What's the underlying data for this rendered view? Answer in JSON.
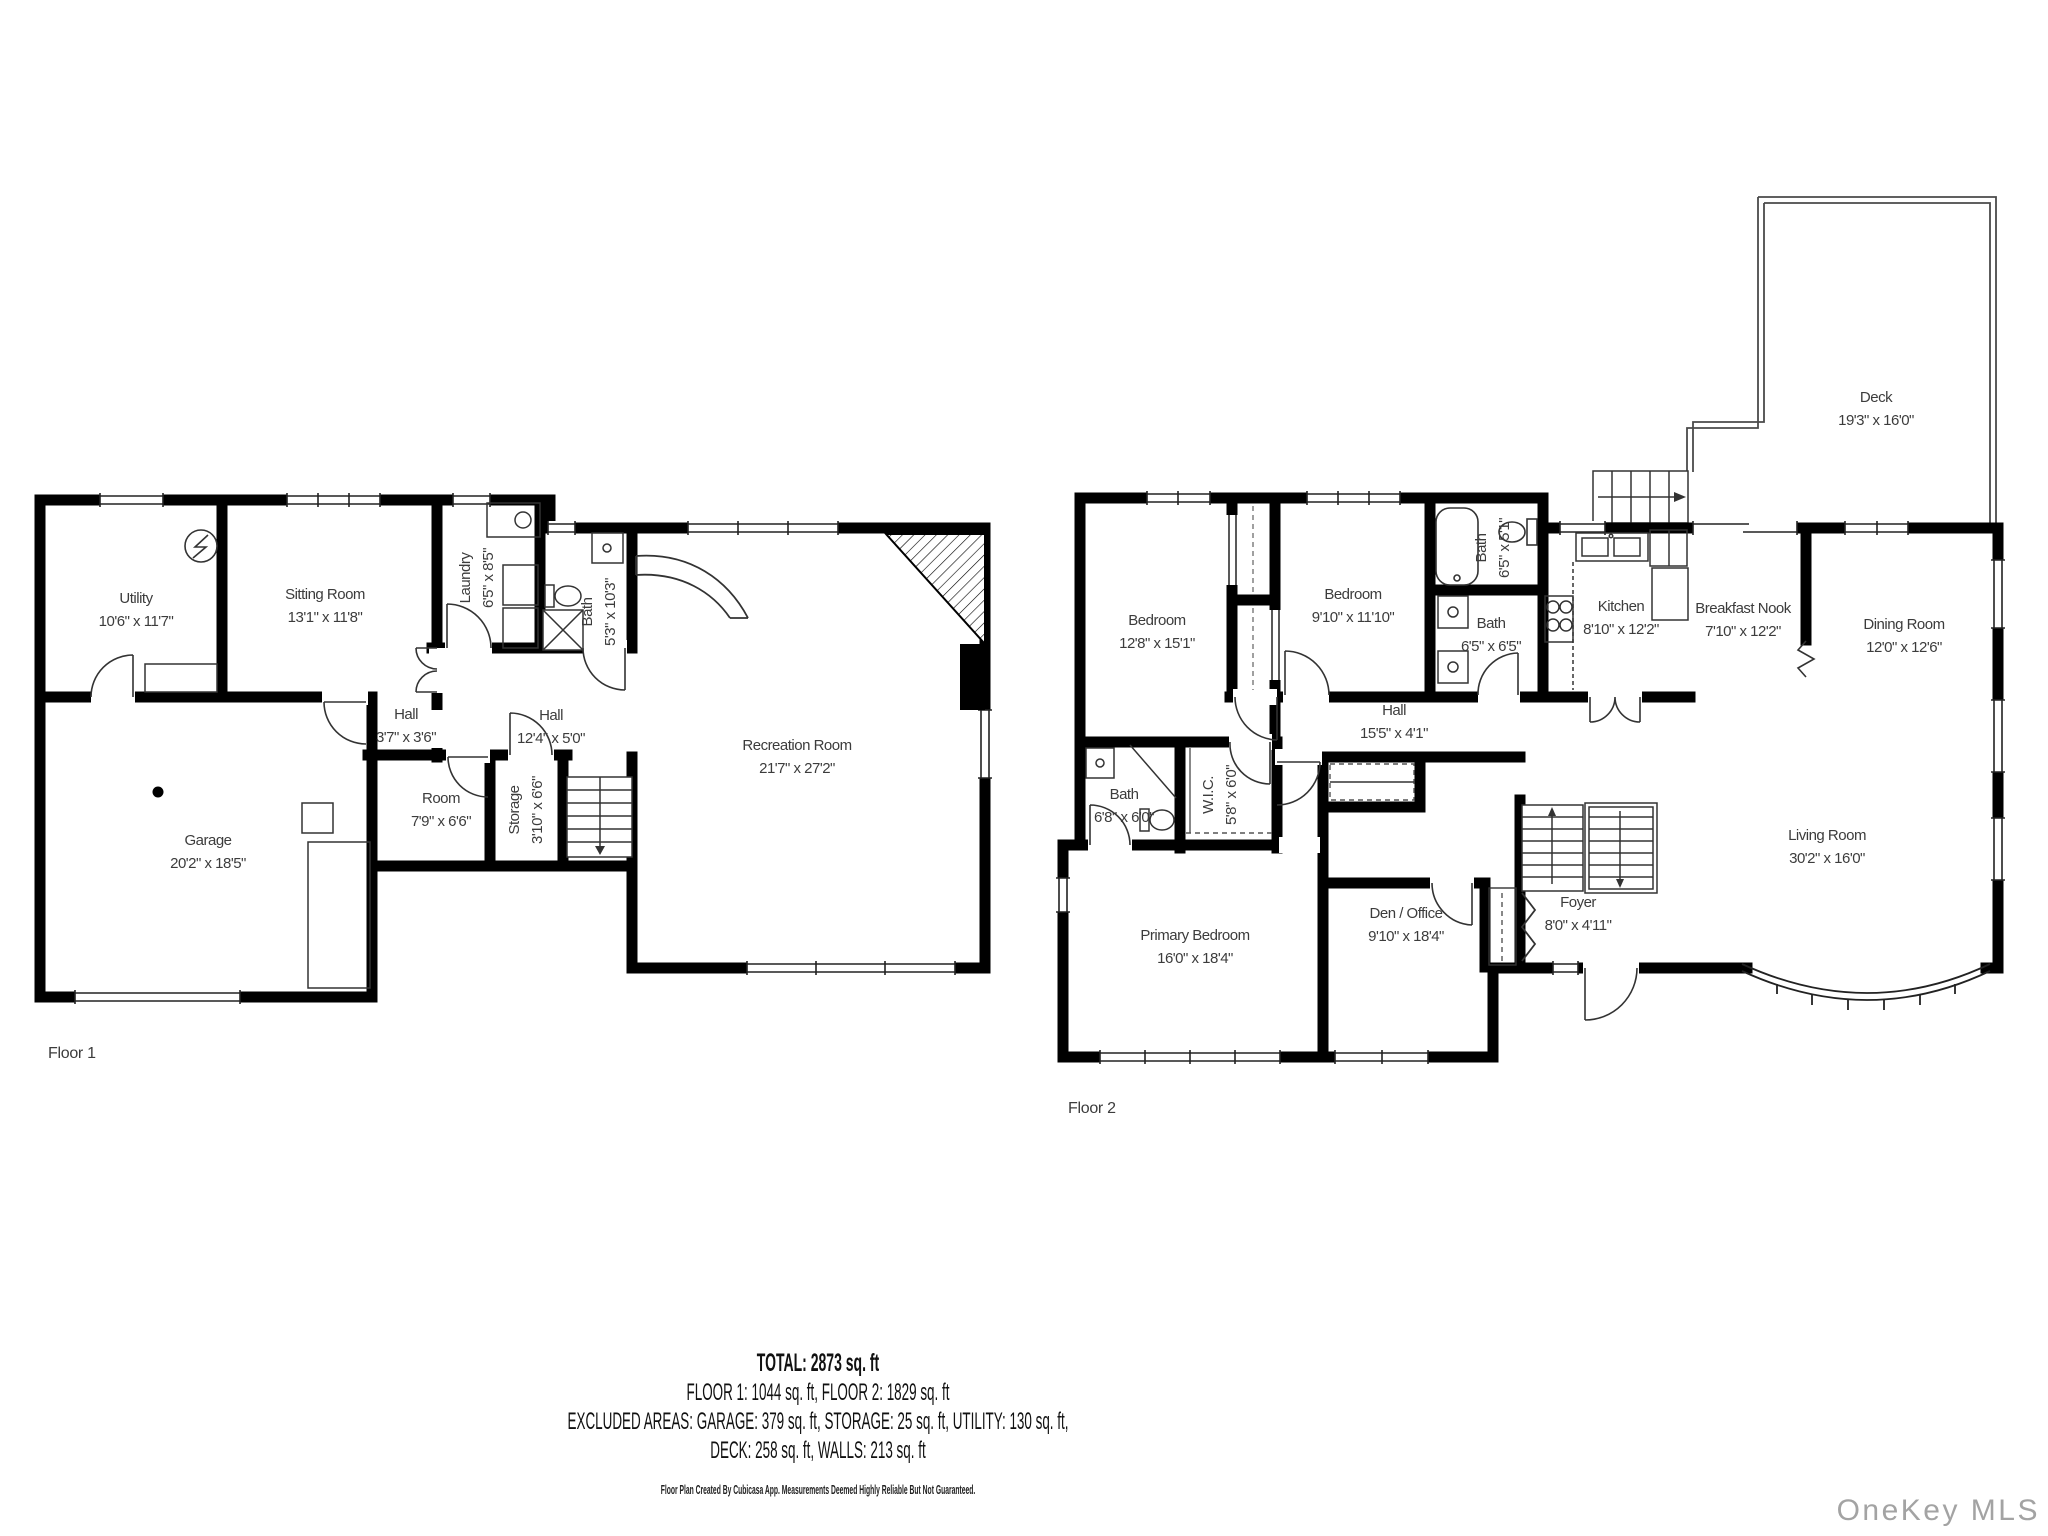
{
  "colors": {
    "wall": "#000000",
    "label_text": "#3c3c3c",
    "summary_text": "#111111",
    "watermark": "#a3a3a3",
    "thin_line": "#222222"
  },
  "floor1": {
    "label": "Floor 1",
    "rooms": {
      "utility": {
        "name": "Utility",
        "dims": "10'6\" x 11'7\""
      },
      "sitting_room": {
        "name": "Sitting Room",
        "dims": "13'1\" x 11'8\""
      },
      "laundry": {
        "name": "Laundry",
        "dims": "6'5\" x 8'5\""
      },
      "bath": {
        "name": "Bath",
        "dims": "5'3\" x 10'3\""
      },
      "hall_small": {
        "name": "Hall",
        "dims": "3'7\" x 3'6\""
      },
      "hall": {
        "name": "Hall",
        "dims": "12'4\" x 5'0\""
      },
      "room": {
        "name": "Room",
        "dims": "7'9\" x 6'6\""
      },
      "storage": {
        "name": "Storage",
        "dims": "3'10\" x 6'6\""
      },
      "garage": {
        "name": "Garage",
        "dims": "20'2\" x 18'5\""
      },
      "recreation_room": {
        "name": "Recreation Room",
        "dims": "21'7\" x 27'2\""
      }
    }
  },
  "floor2": {
    "label": "Floor 2",
    "rooms": {
      "bedroom1": {
        "name": "Bedroom",
        "dims": "12'8\" x 15'1\""
      },
      "bedroom2": {
        "name": "Bedroom",
        "dims": "9'10\" x 11'10\""
      },
      "bath_upper": {
        "name": "Bath",
        "dims": "6'5\" x 5'1\""
      },
      "bath_mid": {
        "name": "Bath",
        "dims": "6'5\" x 6'5\""
      },
      "kitchen": {
        "name": "Kitchen",
        "dims": "8'10\" x 12'2\""
      },
      "breakfast_nook": {
        "name": "Breakfast Nook",
        "dims": "7'10\" x 12'2\""
      },
      "dining_room": {
        "name": "Dining Room",
        "dims": "12'0\" x 12'6\""
      },
      "deck": {
        "name": "Deck",
        "dims": "19'3\" x 16'0\""
      },
      "hall": {
        "name": "Hall",
        "dims": "15'5\" x 4'1\""
      },
      "bath_lower": {
        "name": "Bath",
        "dims": "6'8\" x 6'0\""
      },
      "wic": {
        "name": "W.I.C.",
        "dims": "5'8\" x 6'0\""
      },
      "primary_bedroom": {
        "name": "Primary Bedroom",
        "dims": "16'0\" x 18'4\""
      },
      "den_office": {
        "name": "Den / Office",
        "dims": "9'10\" x 18'4\""
      },
      "foyer": {
        "name": "Foyer",
        "dims": "8'0\" x 4'11\""
      },
      "living_room": {
        "name": "Living Room",
        "dims": "30'2\" x 16'0\""
      }
    }
  },
  "summary": {
    "total": "TOTAL: 2873 sq. ft",
    "floors_line": "FLOOR 1: 1044 sq. ft, FLOOR 2: 1829 sq. ft",
    "excluded_line1": "EXCLUDED AREAS: GARAGE: 379 sq. ft, STORAGE: 25 sq. ft, UTILITY: 130 sq. ft,",
    "excluded_line2": "DECK: 258 sq. ft, WALLS: 213 sq. ft",
    "disclaimer": "Floor Plan Created By Cubicasa App. Measurements Deemed Highly Reliable But Not Guaranteed."
  },
  "watermark": "OneKey MLS",
  "icons": {
    "electric_panel": "electric-panel-icon",
    "washer_dryer": "washer-dryer-icon",
    "bathtub": "bathtub-icon",
    "toilet": "toilet-icon",
    "shower": "shower-icon",
    "sink": "sink-icon",
    "stove": "stove-icon",
    "refrigerator": "refrigerator-icon",
    "fireplace": "fireplace-icon",
    "stairs": "stairs-icon",
    "ceiling_light": "ceiling-light-icon",
    "bow_window": "bow-window",
    "deck_stairs": "deck-stairs-icon"
  }
}
